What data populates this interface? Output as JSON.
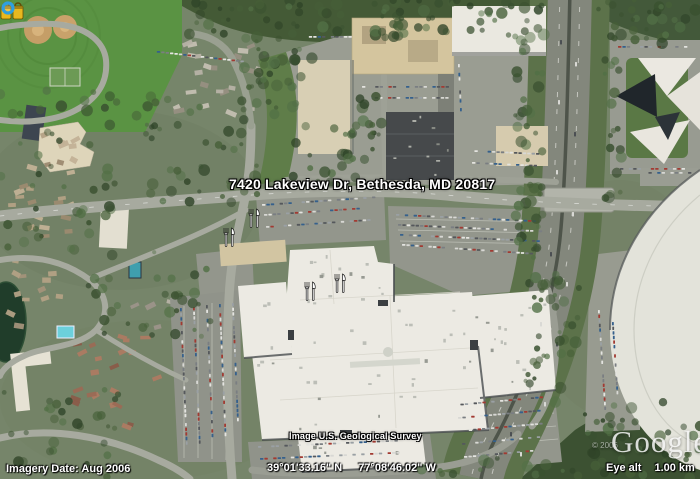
{
  "overlays": {
    "address_label": "7420 Lakeview Dr, Bethesda, MD 20817",
    "attribution": "Image U.S. Geological Survey",
    "copyright_year": "© 2006",
    "logo_text": "Google",
    "logo_trademark": "™"
  },
  "status_bar": {
    "imagery_date": "Imagery Date: Aug 2006",
    "latitude": "39°01'33.16\" N",
    "longitude": "77°08'46.02\" W",
    "eye_alt_label": "Eye alt",
    "eye_alt_value": "1.00 km"
  },
  "poi_icons": {
    "dining": "fork-and-knife",
    "shopping": "yellow-shopping-bags",
    "streaming": "blue-ring"
  },
  "colors": {
    "field_green": "#5a9343",
    "diamond_tan": "#c59e67",
    "forest": "#445a36",
    "road_gray": "#a7aa9f",
    "mall_roof": "#eceae3",
    "parking_gray": "#93968c",
    "pond_green": "#203d2a",
    "pool_blue": "#6cd0dc",
    "poi_yellow": "#e8b81f",
    "streaming_blue": "#2f9fe0"
  }
}
